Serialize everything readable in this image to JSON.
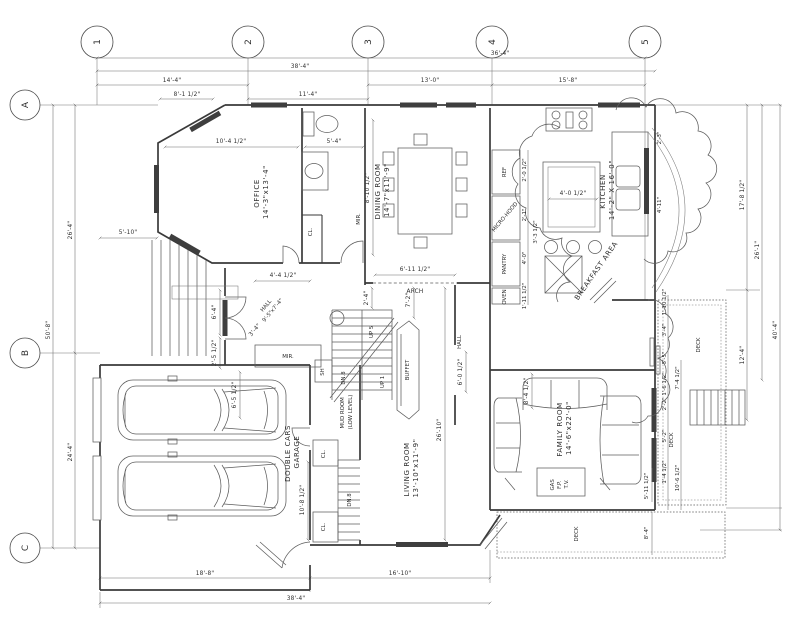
{
  "grid": {
    "columns": [
      "1",
      "2",
      "3",
      "4",
      "5"
    ],
    "rows": [
      "A",
      "B",
      "C"
    ]
  },
  "rooms": {
    "office": {
      "name": "OFFICE",
      "size": "14'-3\"x13'-4\""
    },
    "dining": {
      "name": "DINING ROOM",
      "size": "14'-7\"x11'-9\""
    },
    "kitchen": {
      "name": "KITCHEN",
      "size": "14'-2\" X 16'-0\""
    },
    "family": {
      "name": "FAMILY ROOM",
      "size": "14'-6\"x22'-0\""
    },
    "living": {
      "name": "LIVING ROOM",
      "size": "13'-10\"x11'-9\""
    },
    "garage": {
      "l1": "DOUBLE CARS",
      "l2": "GARAGE"
    },
    "mud": {
      "l1": "MUD ROOM",
      "l2": "(LOW LEVEL)"
    },
    "hall": {
      "name": "HALL",
      "size": "9'-5\"x7'-4\""
    },
    "hall2": {
      "name": "HALL"
    }
  },
  "labels": {
    "arch": "ARCH",
    "buffet": "BUFFET",
    "pantry": "PANTRY",
    "ref": "REF",
    "micro": "MICRO-HOOD",
    "oven": "OVEN",
    "breakfast": "BREAKFAST AREA",
    "deck_right": "DECK",
    "deck_right2": "DECK",
    "deck_bottom": "DECK",
    "mir1": "MIR.",
    "mir2": "MIR.",
    "sh": "SH",
    "cl1": "CL.",
    "cl2": "CL.",
    "cl3": "CL.",
    "dn8": "DN.8",
    "dn8b": "DN.8",
    "up1": "UP 1",
    "up5": "UP 5",
    "gas1": "GAS",
    "gas2": "F.P.",
    "gas3": "T.V."
  },
  "dims": {
    "top_overall_a": "36'-4\"",
    "top_overall_b": "38'-4\"",
    "top_1_2": "14'-4\"",
    "top_2_3": "11'-4\"",
    "top_3_4": "13'-0\"",
    "top_4_5": "15'-8\"",
    "top_office_bay": "8'-1 1/2\"",
    "office_width": "10'-4 1/2\"",
    "powder_width": "5'-4\"",
    "powder_depth": "8'-10 1/2\"",
    "arch_width": "6'-11 1/2\"",
    "island_width": "4'-0 1/2\"",
    "hall_closet": "4'-4 1/2\"",
    "hall_diag": "3'-4\"",
    "hall_width": "6'-0 1/2\"",
    "stair_width": "2'-4\"",
    "buffet_hall": "7'-2\"",
    "living_depth": "26'-10\"",
    "mud_stair": "10'-8 1/2\"",
    "porch_width": "5'-10\"",
    "entry_window": "6'-4\"",
    "entry_side": "2'-5 1/2\"",
    "garage_clear": "6'-5 1/2\"",
    "left_a_b": "26'-4\"",
    "left_b_c": "24'-4\"",
    "left_overall": "50'-8\"",
    "bottom_garage": "18'-8\"",
    "bottom_living": "16'-10\"",
    "bottom_overall": "38'-4\"",
    "right_top": "17'-8 1/2\"",
    "right_mid": "26'-1\"",
    "right_deck": "12'-4\"",
    "right_overall": "40'-4\"",
    "deck_w1": "1'-10 1/2\"",
    "deck_w2": "3'-4\"",
    "deck_w3": "5'-5\"",
    "deck_w4": "1'-6 1/2\"",
    "fam_r1": "7'-4 1/2\"",
    "fam_r2": "2'-2\"",
    "fam_r3": "5'-2\"",
    "fam_r4": "1'-4 1/2\"",
    "fam_r5": "10'-6 1/2\"",
    "fam_inner": "8'-4 1/2\"",
    "deck_b1": "5'-11 1/2\"",
    "deck_b2": "8'-4\"",
    "kcab_1": "2'-0 1/2\"",
    "kcab_2": "2'-1\"",
    "kcab_3": "4'-0\"",
    "kcab_4": "1'-11 1/2\"",
    "kcab_5": "3'-3 1/2\"",
    "kit_r1": "2'-3\"",
    "kit_r2": "4'-11\""
  }
}
